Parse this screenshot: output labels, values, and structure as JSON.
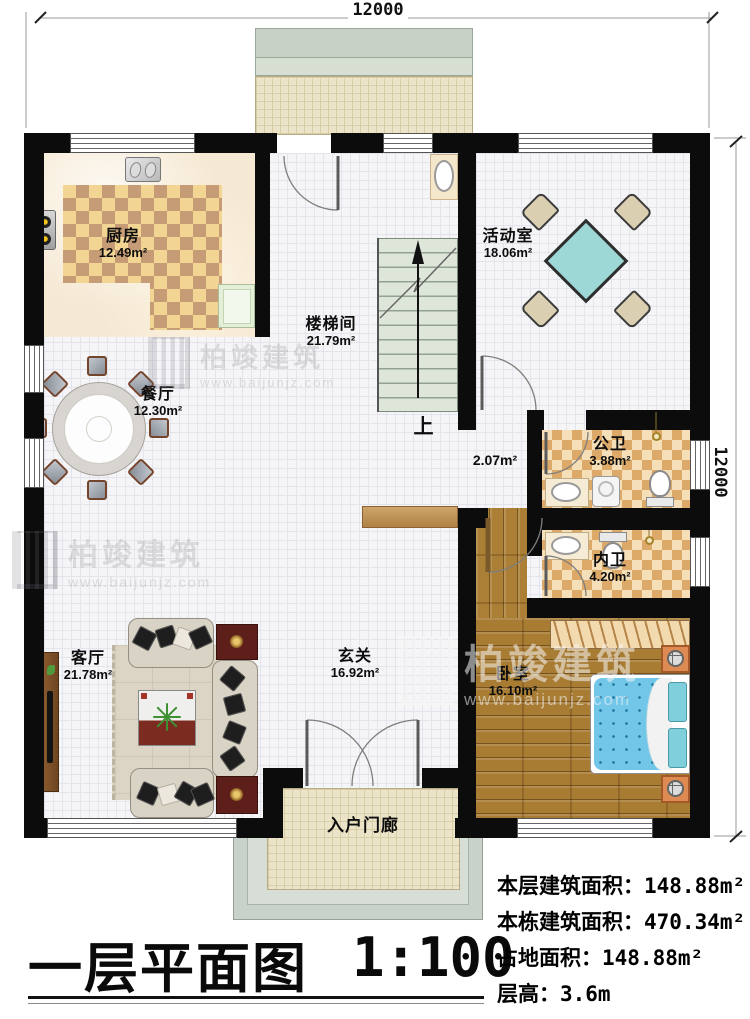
{
  "watermark": {
    "brand": "柏竣建筑",
    "website": "www.baijunjz.com"
  },
  "dimensions": {
    "top": "12000",
    "right": "12000"
  },
  "rooms": {
    "kitchen": {
      "name": "厨房",
      "area": "12.49m²"
    },
    "stairwell": {
      "name": "楼梯间",
      "area": "21.79m²"
    },
    "activity": {
      "name": "活动室",
      "area": "18.06m²"
    },
    "dining": {
      "name": "餐厅",
      "area": "12.30m²"
    },
    "hallway": {
      "area": "2.07m²"
    },
    "public_bath": {
      "name": "公卫",
      "area": "3.88m²"
    },
    "private_bath": {
      "name": "内卫",
      "area": "4.20m²"
    },
    "living": {
      "name": "客厅",
      "area": "21.78m²"
    },
    "foyer": {
      "name": "玄关",
      "area": "16.92m²"
    },
    "bedroom": {
      "name": "卧室",
      "area": "16.10m²"
    },
    "porch": {
      "name": "入户门廊"
    }
  },
  "stairs": {
    "direction_label": "上"
  },
  "titleblock": {
    "plan_title": "一层平面图",
    "scale": "1:100"
  },
  "stats": [
    {
      "label": "本层建筑面积：",
      "value": "148.88m²"
    },
    {
      "label": "本栋建筑面积：",
      "value": "470.34m²"
    },
    {
      "label": "占地面积：",
      "value": "148.88m²"
    },
    {
      "label": "层高：",
      "value": "3.6m"
    }
  ]
}
